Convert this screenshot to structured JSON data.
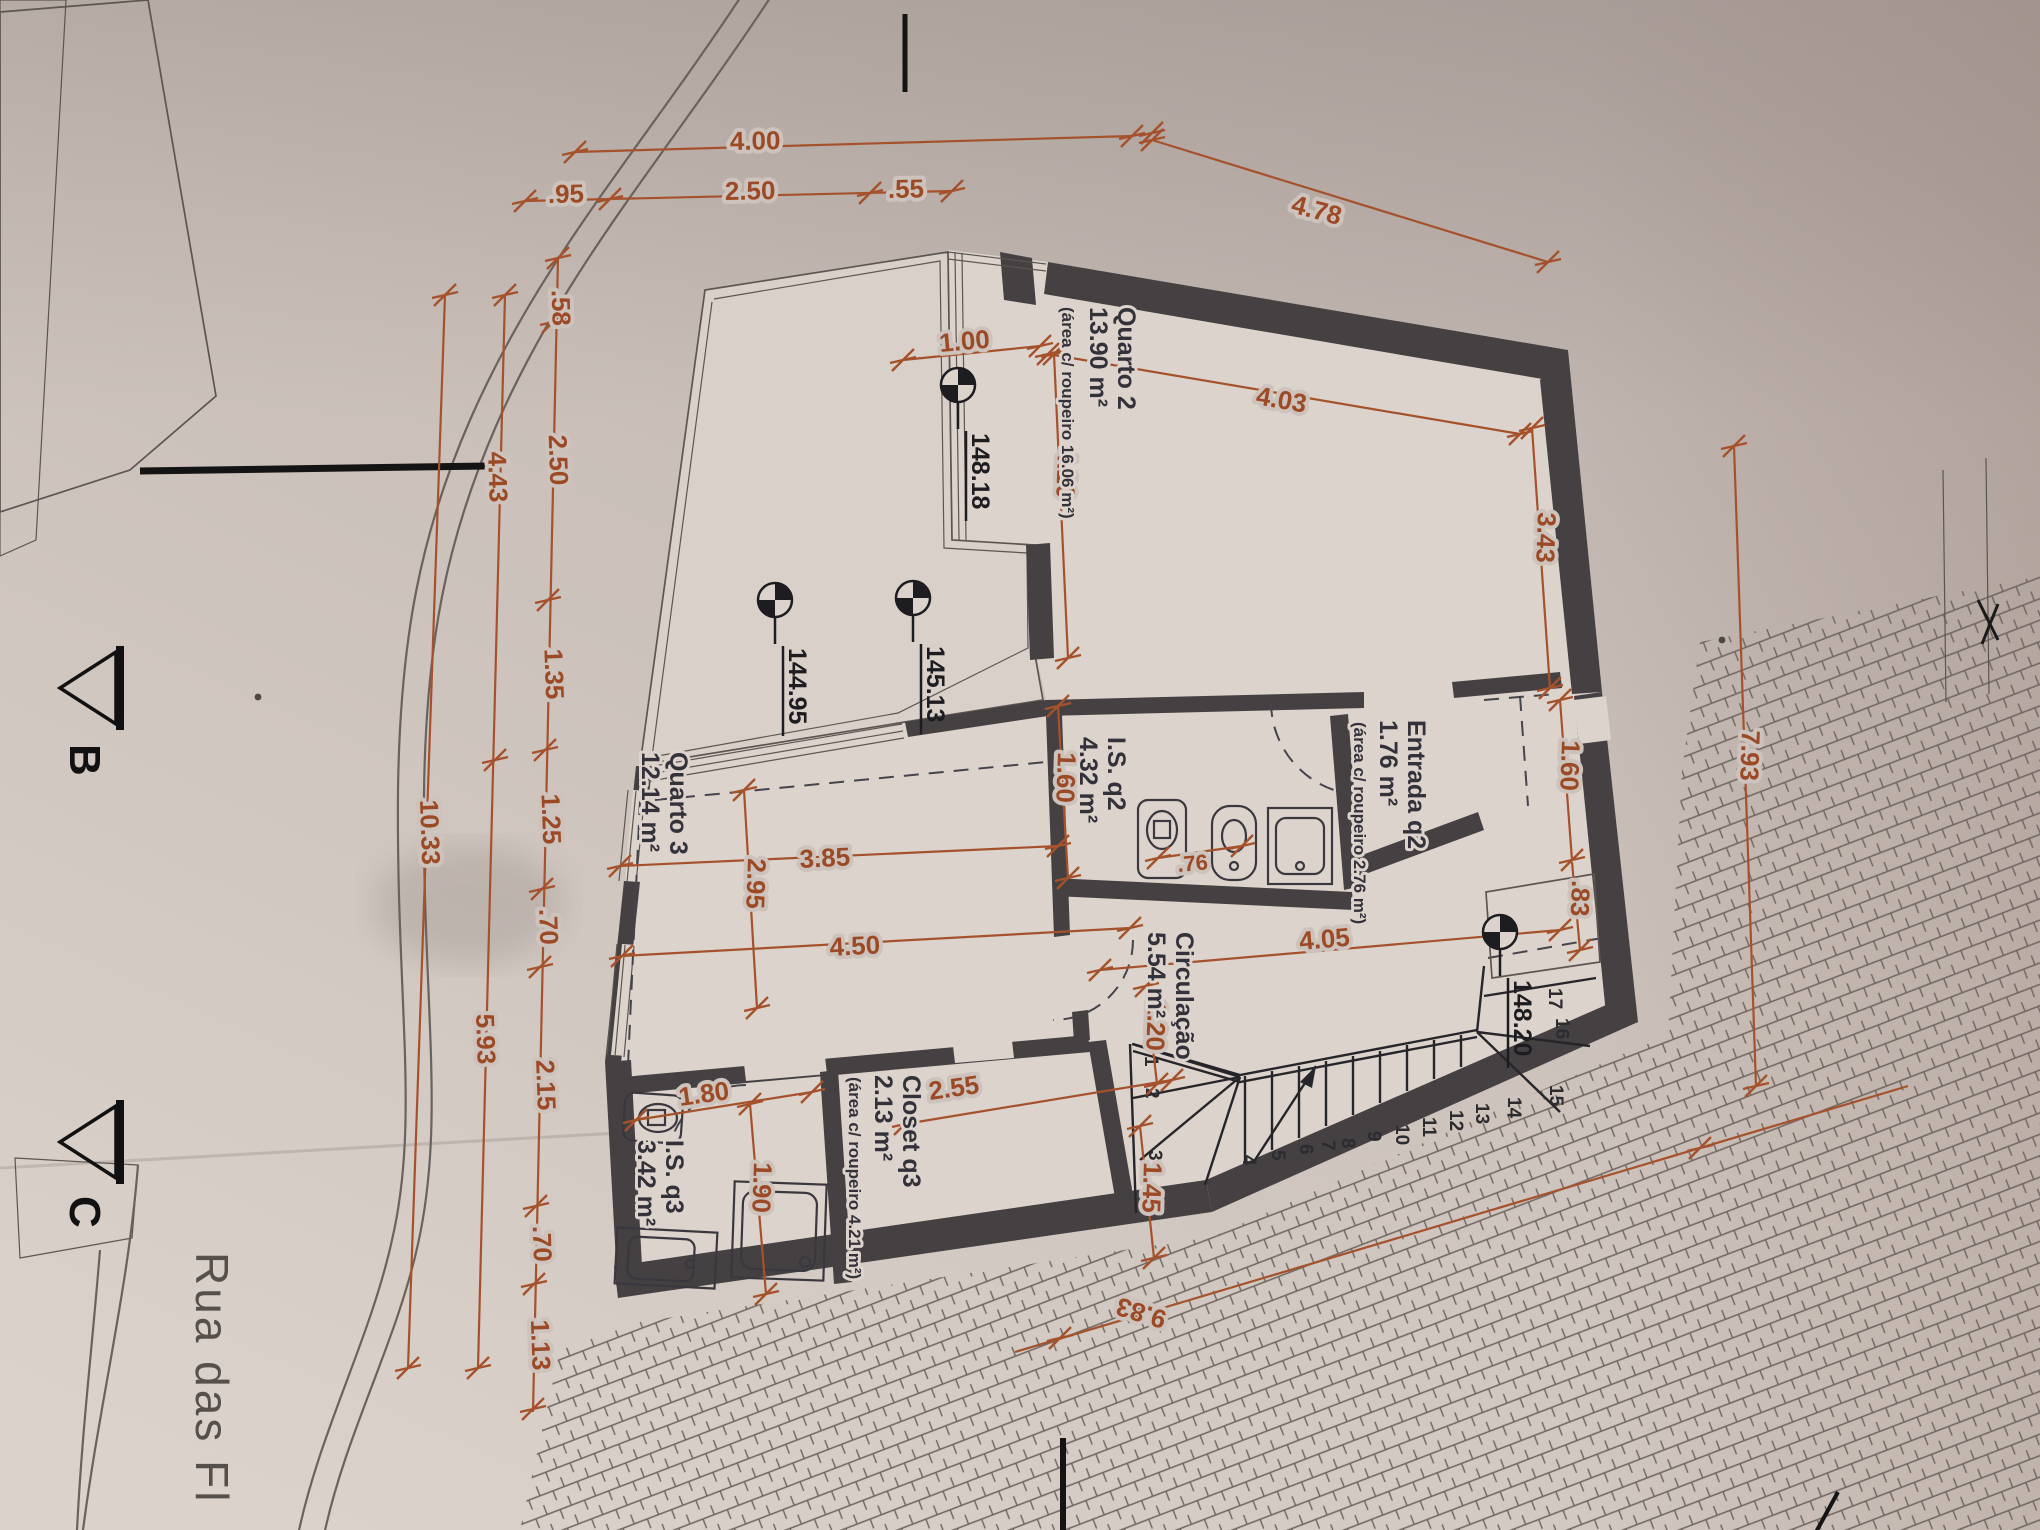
{
  "drawing": {
    "street_label": "Rua das Fl",
    "section_markers": {
      "b": "B",
      "c": "C"
    },
    "rooms": {
      "quarto2": {
        "name": "Quarto 2",
        "area": "13.90 m²",
        "area_note": "(área c/ roupeiro 16.06 m²)"
      },
      "entrada_q2": {
        "name": "Entrada q2",
        "area": "1.76 m²",
        "area_note": "(área c/ roupeiro 2.76 m²)"
      },
      "is_q2": {
        "name": "I.S. q2",
        "area": "4.32 m²"
      },
      "circulacao": {
        "name": "Circulação",
        "area": "5.54 m²"
      },
      "quarto3": {
        "name": "Quarto 3",
        "area": "12.14 m²"
      },
      "closet_q3": {
        "name": "Closet q3",
        "area": "2.13 m²",
        "area_note": "(área c/ roupeiro 4.21 m²)"
      },
      "is_q3": {
        "name": "I.S. q3",
        "area": "3.42 m²"
      }
    },
    "elevation_markers": [
      "148.18",
      "145.13",
      "144.95",
      "148.20"
    ],
    "dimensions": {
      "top": [
        "4.00",
        ".95",
        "2.50",
        ".55",
        "4.78"
      ],
      "left_chain_inner": [
        ".58",
        "2.50",
        "1.35",
        "1.25",
        ".70",
        "2.15",
        ".70",
        "1.13"
      ],
      "left_chain_mid": [
        "4.43",
        "5.93"
      ],
      "left_chain_outer": [
        "10.33"
      ],
      "interior": [
        "1.00",
        "4.03",
        "3.43",
        "4.20",
        "1.60",
        ".83",
        "1.60",
        ".76",
        "3.85",
        "2.95",
        "4.50",
        "1.20",
        "4.05",
        "7.93",
        "2.55",
        "1.45",
        "1.80",
        "1.90",
        "9.83"
      ]
    },
    "stairs": {
      "numbers": [
        "1",
        "2",
        "3",
        "4",
        "5",
        "6",
        "7",
        "8",
        "9",
        "10",
        "11",
        "12",
        "13",
        "14",
        "15",
        "16",
        "17"
      ]
    },
    "colors": {
      "dimension": "#a5522c",
      "wall": "#454143",
      "paper": "#cdc3bc",
      "ink": "#33313a"
    }
  }
}
